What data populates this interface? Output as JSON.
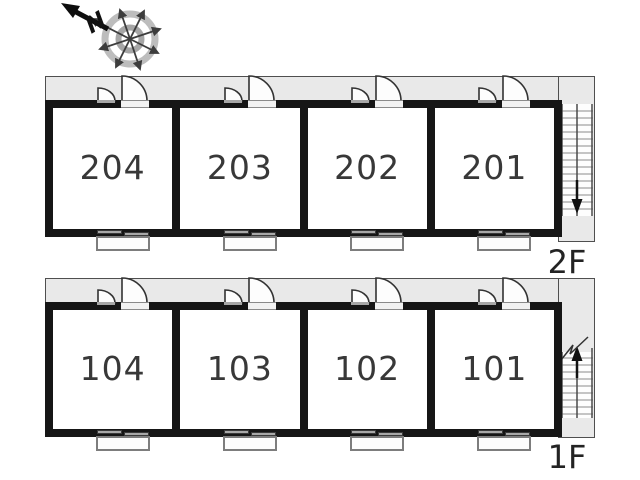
{
  "compass": {
    "north_label": "N"
  },
  "floors": [
    {
      "label": "2F",
      "stair_direction": "down",
      "rooms": [
        {
          "number": "204"
        },
        {
          "number": "203"
        },
        {
          "number": "202"
        },
        {
          "number": "201"
        }
      ]
    },
    {
      "label": "1F",
      "stair_direction": "up",
      "rooms": [
        {
          "number": "104"
        },
        {
          "number": "103"
        },
        {
          "number": "102"
        },
        {
          "number": "101"
        }
      ]
    }
  ],
  "colors": {
    "wall": "#161616",
    "corridor_fill": "#e9e9e9",
    "corridor_border": "#4f4f4f",
    "room_fill": "#ffffff",
    "text": "#383838",
    "stair_line": "#8a8a8a",
    "stair_rail": "#4a4a4a",
    "window_bar": "#a8a8a8",
    "balcony_border": "#7d7d7d",
    "compass_ring_outer": "#bdbdbd",
    "compass_ring_inner": "#a6a6a6",
    "compass_spoke": "#3d3d3d",
    "north_arrow": "#0e0e0e"
  }
}
